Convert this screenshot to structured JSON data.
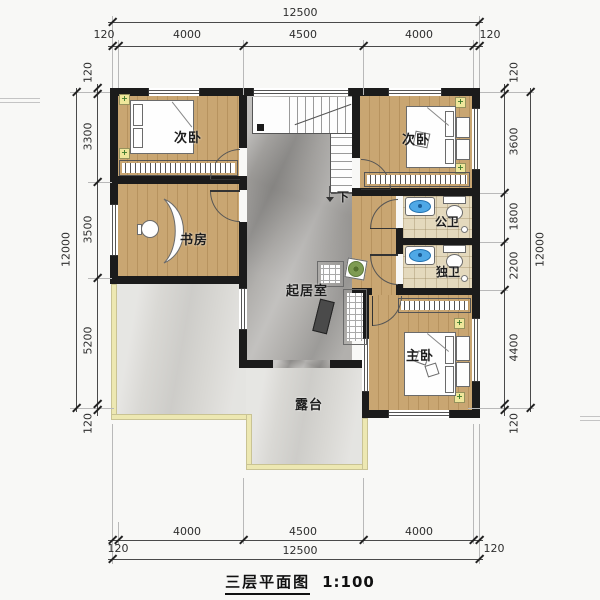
{
  "title": {
    "text": "三层平面图",
    "scale": "1:100"
  },
  "rooms": {
    "bedroom_tl": "次卧",
    "bedroom_tr": "次卧",
    "study": "书房",
    "living": "起居室",
    "bath_public": "公卫",
    "bath_private": "独卫",
    "master": "主卧",
    "terrace": "露台",
    "stairs_down": "下"
  },
  "dims": {
    "top": {
      "total": "12500",
      "segments": [
        "120",
        "4000",
        "4500",
        "4000",
        "120"
      ]
    },
    "bottom": {
      "total": "12500",
      "segments": [
        "120",
        "4000",
        "4500",
        "4000",
        "120"
      ]
    },
    "left": {
      "total": "12000",
      "segments": [
        "120",
        "3300",
        "3500",
        "5200",
        "120"
      ]
    },
    "right": {
      "total": "12000",
      "segments": [
        "120",
        "3600",
        "1800",
        "2200",
        "4400",
        "120"
      ]
    }
  },
  "colors": {
    "wall": "#1b1b1b",
    "wood_floor": "#c9a672",
    "marble_floor": "#a7a5a2",
    "terrace_floor": "#d9d8d4",
    "terrace_border": "#ede8b2",
    "bath_tile": "#e4d9bd",
    "fixture_blue": "#4fa8e6",
    "lamp_yellow": "#efe79b"
  }
}
